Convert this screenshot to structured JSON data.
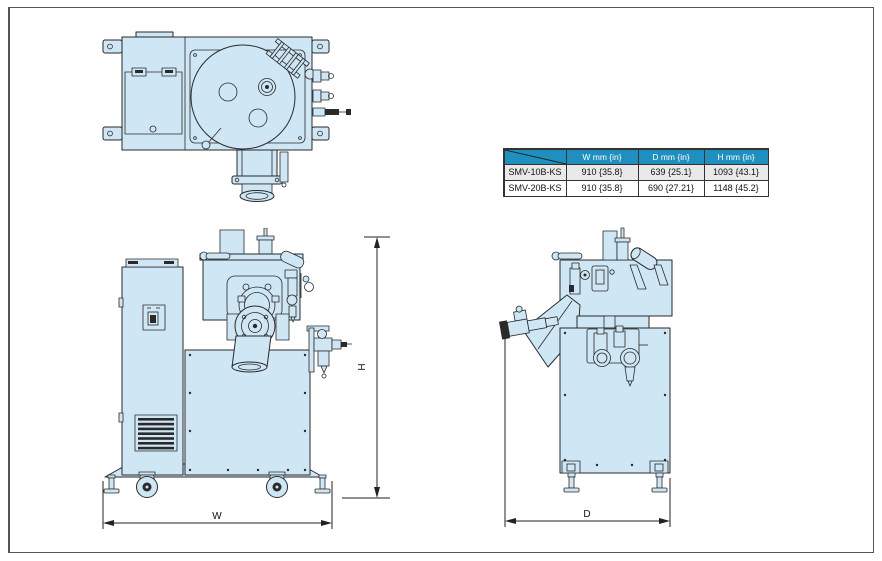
{
  "table": {
    "headers": [
      "",
      "W mm {in}",
      "D mm {in}",
      "H mm {in}"
    ],
    "rows": [
      [
        "SMV-10B-KS",
        "910 {35.8}",
        "639 {25.1}",
        "1093 {43.1}"
      ],
      [
        "SMV-20B-KS",
        "910 {35.8}",
        "690 {27.21}",
        "1148 {45.2}"
      ]
    ]
  },
  "dimensions": {
    "width_label": "W",
    "depth_label": "D",
    "height_label": "H"
  },
  "colors": {
    "machine_fill": "#cfe6f5",
    "line": "#2a2a2a",
    "dim_line": "#222222",
    "table_header_bg": "#1f8fbf",
    "table_header_text": "#ffffff",
    "table_row_alt_bg": "#e9e9e9",
    "table_border": "#333333",
    "page_border": "#555555"
  }
}
